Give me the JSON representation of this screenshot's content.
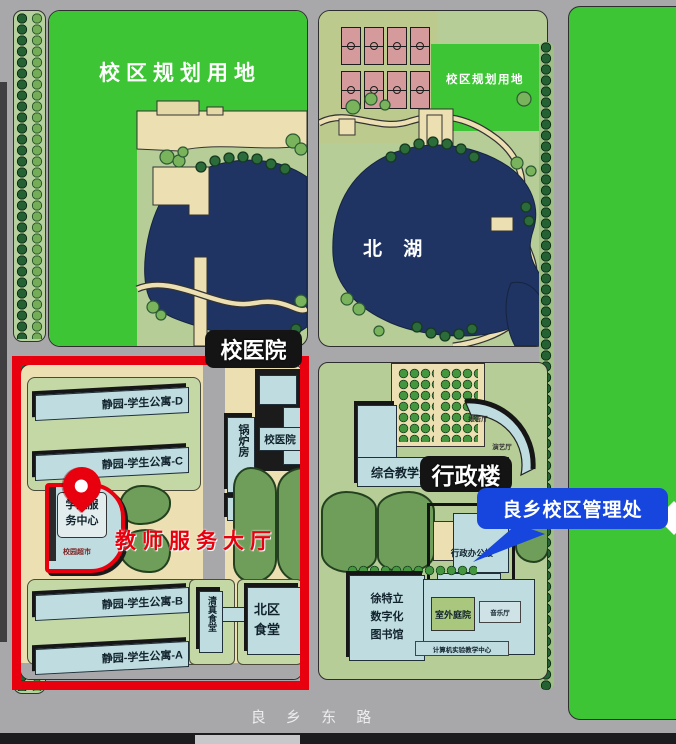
{
  "labels": {
    "planning_left": "校区规划用地",
    "planning_right": "校区规划用地",
    "north_lake": "北 湖",
    "hospital_tag": "校医院",
    "admin_tag": "行政楼",
    "mgmt_tag": "良乡校区管理处",
    "teacher_hall": "教师服务大厅",
    "south_road": "良 乡 东 路"
  },
  "buildings": {
    "dorm_d": "静园-学生公寓-D",
    "dorm_c": "静园-学生公寓-C",
    "dorm_b": "静园-学生公寓-B",
    "dorm_a": "静园-学生公寓-A",
    "boiler_house": "锅炉房",
    "campus_hospital": "校医院",
    "student_center_l1": "学生服",
    "student_center_l2": "务中心",
    "campus_supermarket": "校园超市",
    "halal_canteen": "清真食堂",
    "north_canteen_l1": "北区",
    "north_canteen_l2": "食堂",
    "teaching_building": "综合教学大楼",
    "lecture_hall": "报告厅",
    "perf_hall": "演艺厅",
    "admin_office": "行政办公楼",
    "library_l1": "徐特立",
    "library_l2": "数字化",
    "library_l3": "图书馆",
    "outdoor_courtyard": "室外庭院",
    "music_hall": "音乐厅",
    "computer_center": "计算机实验教学中心"
  },
  "colors": {
    "highlight_red": "#e8000f",
    "callout_blue": "#1646dd",
    "planning_green": "#3dc535",
    "lake_navy": "#1f3463",
    "building_blue": "#bfdce0",
    "road_gray": "#a8a8ab",
    "grass_green": "#b6cd98"
  }
}
